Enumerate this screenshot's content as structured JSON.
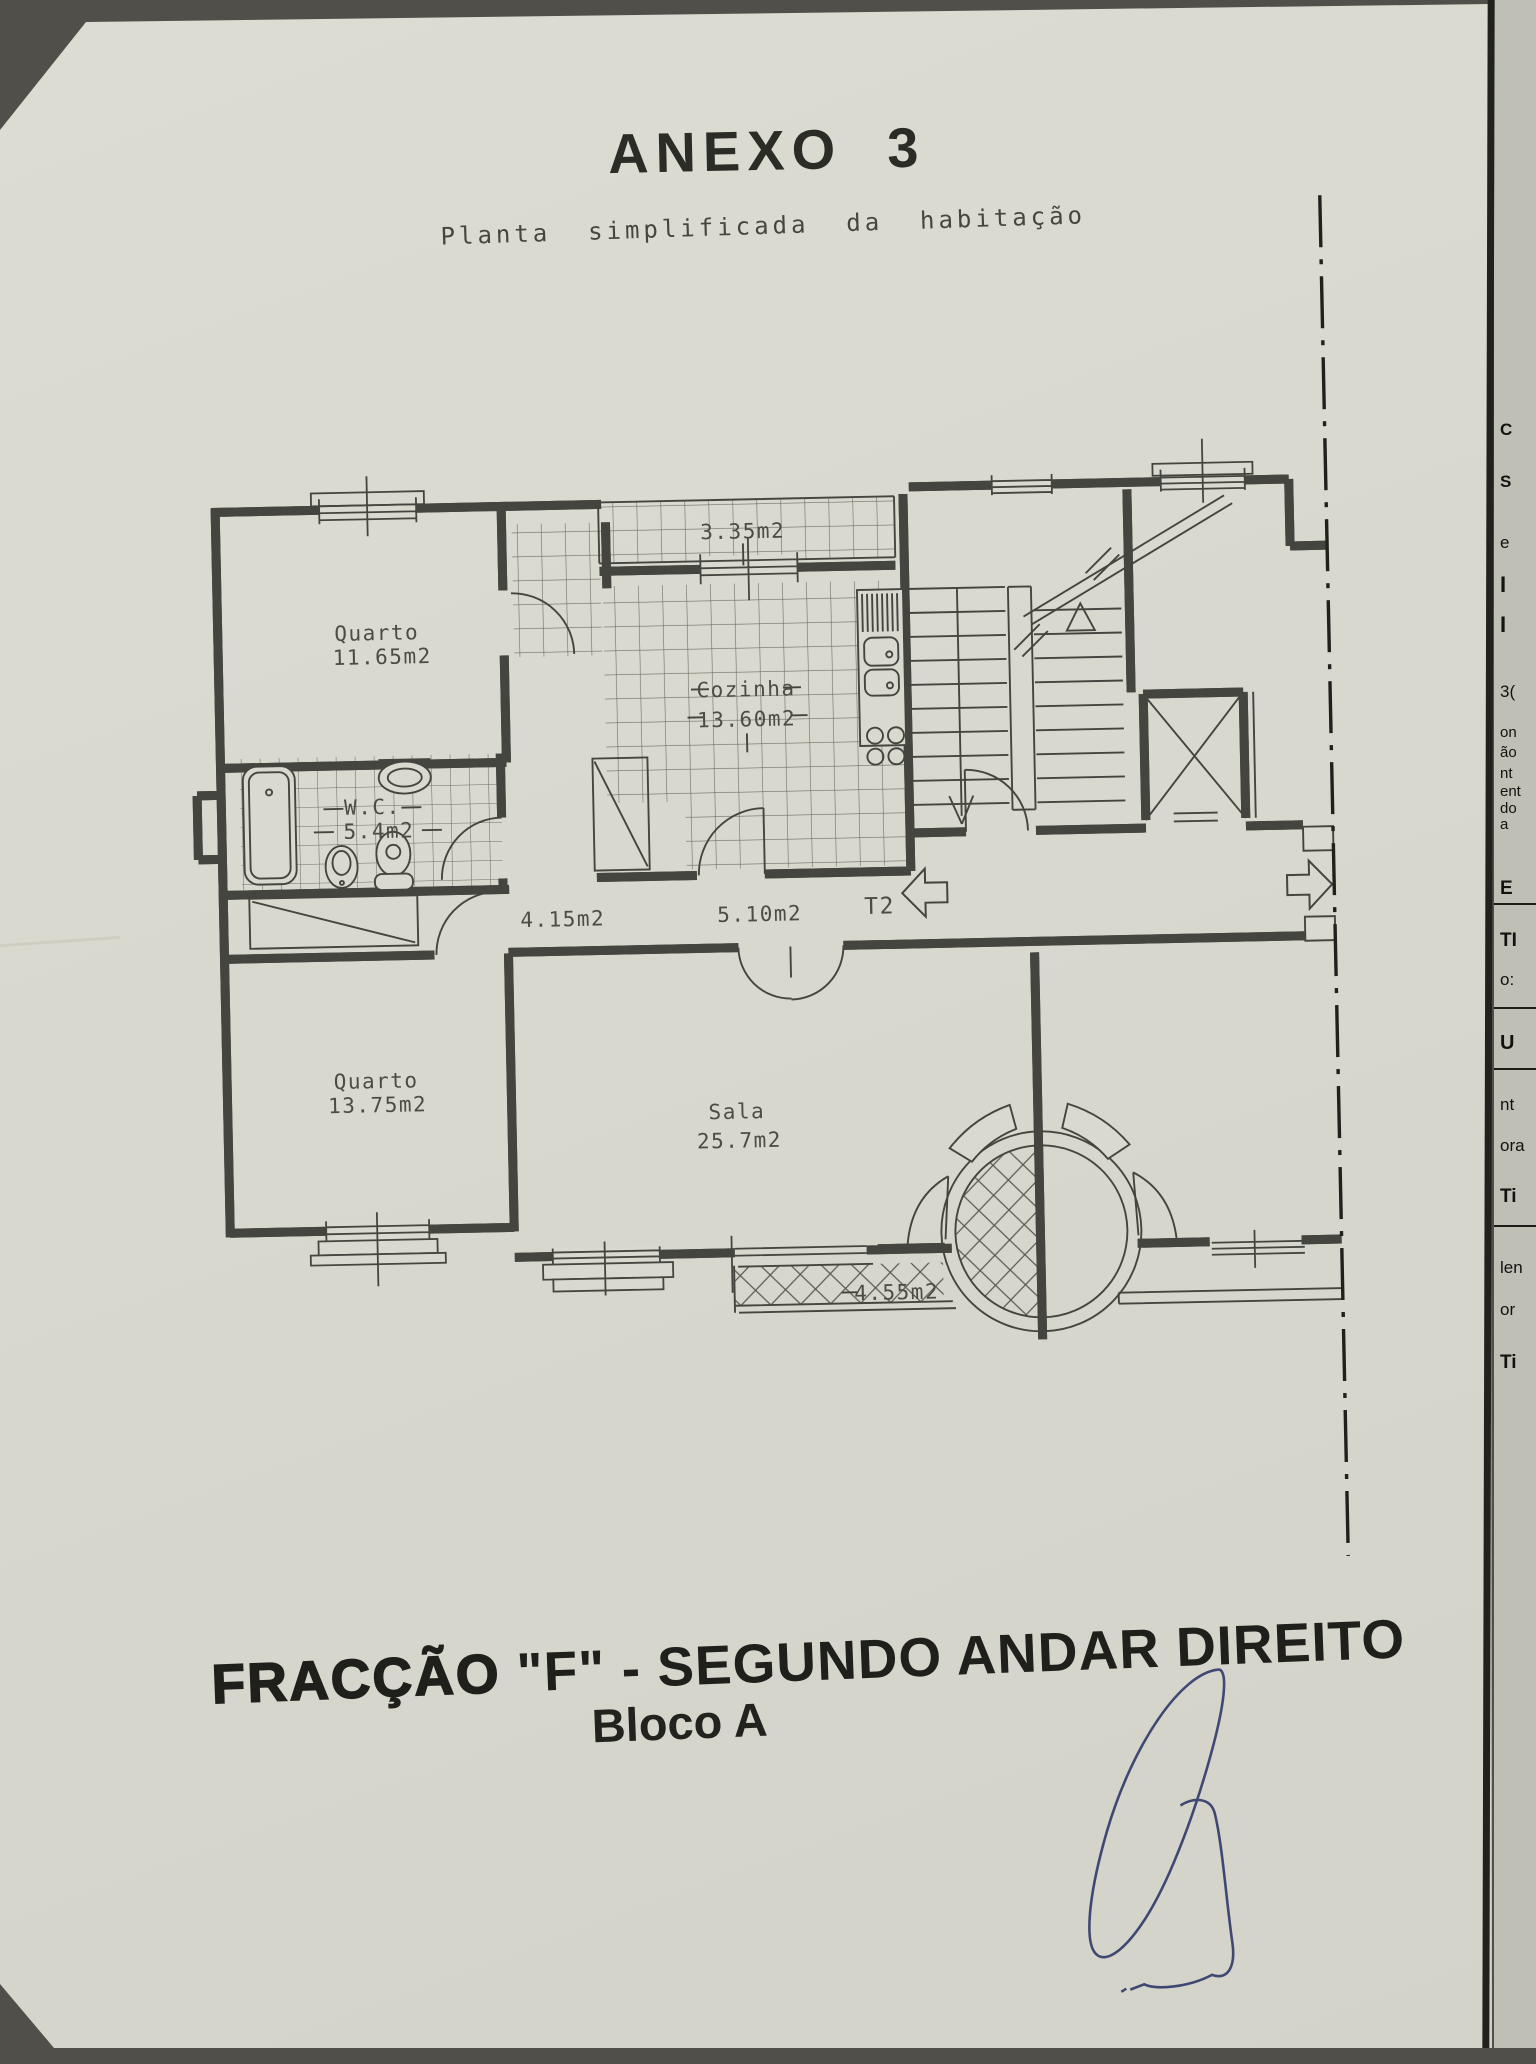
{
  "document": {
    "title": "ANEXO  3",
    "subtitle": "Planta  simplificada  da  habitação",
    "footer": {
      "fraction_word": "FRACÇÃO",
      "fraction_rest": " \"F\" - SEGUNDO ANDAR DIREITO",
      "block": "Bloco A"
    }
  },
  "plan": {
    "unit_type": "T2",
    "rooms": {
      "quarto1_name": "Quarto",
      "quarto1_area": "11.65m2",
      "varanda_top_area": "3.35m2",
      "cozinha_name": "Cozinha",
      "cozinha_area": "13.60m2",
      "wc_name": "W.C.",
      "wc_area": "5.4m2",
      "hall_area": "4.15m2",
      "corredor_area": "5.10m2",
      "quarto2_name": "Quarto",
      "quarto2_area": "13.75m2",
      "sala_name": "Sala",
      "sala_area": "25.7m2",
      "varanda_bottom_area": "4.55m2"
    }
  },
  "underlying_page_fragments": [
    {
      "text": "C"
    },
    {
      "text": "S"
    },
    {
      "text": "e"
    },
    {
      "text": "I"
    },
    {
      "text": "I"
    },
    {
      "text": "3("
    },
    {
      "text": "on"
    },
    {
      "text": "ão"
    },
    {
      "text": "nt"
    },
    {
      "text": "ent"
    },
    {
      "text": "do"
    },
    {
      "text": "a"
    },
    {
      "text": "E"
    },
    {
      "text": "TI"
    },
    {
      "text": "o:"
    },
    {
      "text": "U"
    },
    {
      "text": "nt"
    },
    {
      "text": "ora"
    },
    {
      "text": "Ti"
    },
    {
      "text": "len"
    },
    {
      "text": "or"
    },
    {
      "text": "Ti"
    }
  ],
  "colors": {
    "paper": "#d9d9cf",
    "ink": "#45453f",
    "signature_blue": "#333d6b",
    "underlying_paper": "#bfbfb6"
  }
}
